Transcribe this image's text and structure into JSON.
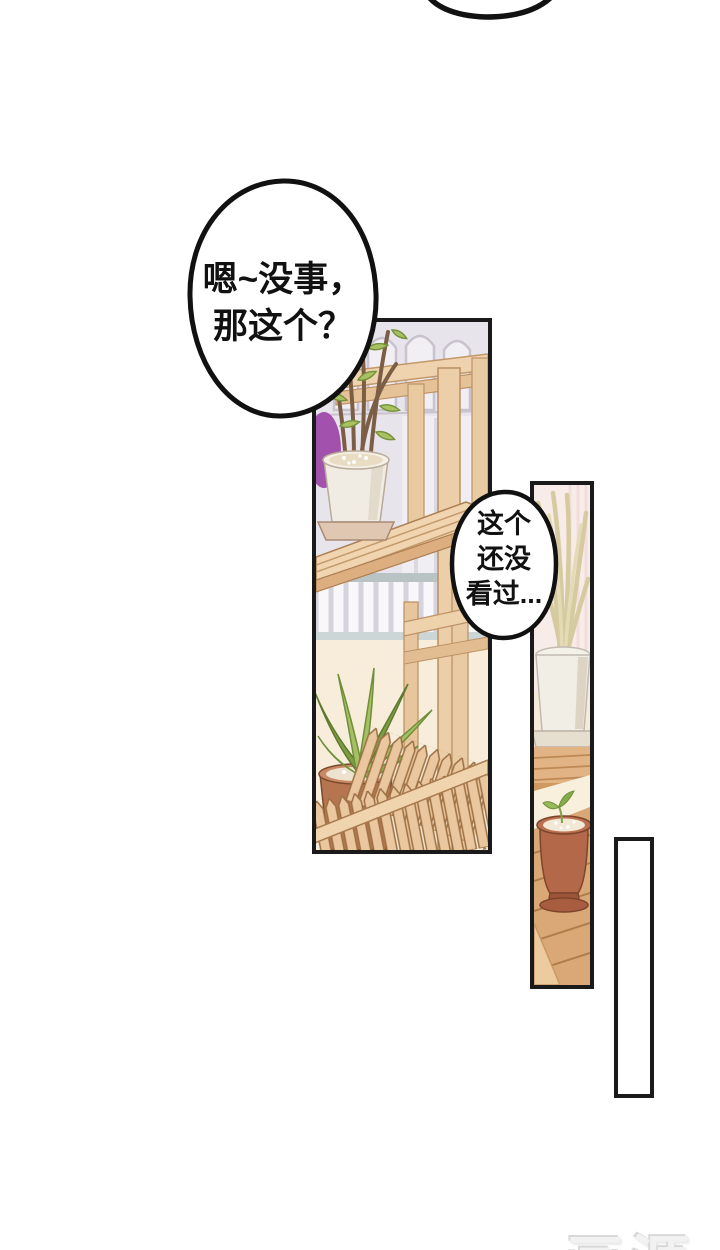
{
  "page": {
    "width": 720,
    "height": 1250,
    "background": "#ffffff"
  },
  "speech_bubbles": {
    "bubble_top_partial": {
      "shape": "bottom-arc-of-offscreen-bubble",
      "lines": []
    },
    "bubble_main": {
      "lines": [
        "嗯~没事，",
        "那这个？"
      ],
      "text_color": "#111111",
      "fill": "#ffffff",
      "outline": "#111111"
    },
    "bubble_small": {
      "lines": [
        "这个",
        "还没",
        "看过..."
      ],
      "text_color": "#111111",
      "fill": "#ffffff",
      "outline": "#111111"
    }
  },
  "panels": {
    "panel_plant_stand": {
      "content": "wooden plant stand with white pot plant, purple pot, palm plant in terracotta pot, picket fence, balcony railing",
      "border_color": "#1a1a1a"
    },
    "panel_tall_plant": {
      "content": "tall pale grass plant in white pot on deck, terracotta seedling pot on wooden slats",
      "border_color": "#1a1a1a"
    },
    "panel_empty": {
      "content": "",
      "border_color": "#1a1a1a",
      "fill": "#ffffff"
    }
  },
  "watermark": {
    "text": "画涯",
    "color": "#f2f2f2",
    "shadow": "#d9d9d9"
  },
  "palette": {
    "panel_border": "#1a1a1a",
    "bubble_outline": "#111111",
    "wall_lavender": "#e8e4ec",
    "arch_line": "#c8c3ce",
    "railing_white": "#f8f7f9",
    "railing_cap": "#b9c3c4",
    "floor_cream": "#f7edda",
    "wood_light": "#eccfa9",
    "wood_mid": "#dcae80",
    "wood_deck": "#d9a876",
    "wood_line": "#b98f60",
    "picket": "#eac79e",
    "leaf_green": "#a6bf63",
    "leaf_dark": "#7e9c42",
    "stem_brown": "#7c5e45",
    "terracotta": "#b5754f",
    "white_pot": "#f1eee6",
    "soil_speckle": "#ece2cf",
    "purple_pot": "#a251ad",
    "pink_wall": "#f8ece9",
    "grass_pale": "#d6cba0"
  }
}
